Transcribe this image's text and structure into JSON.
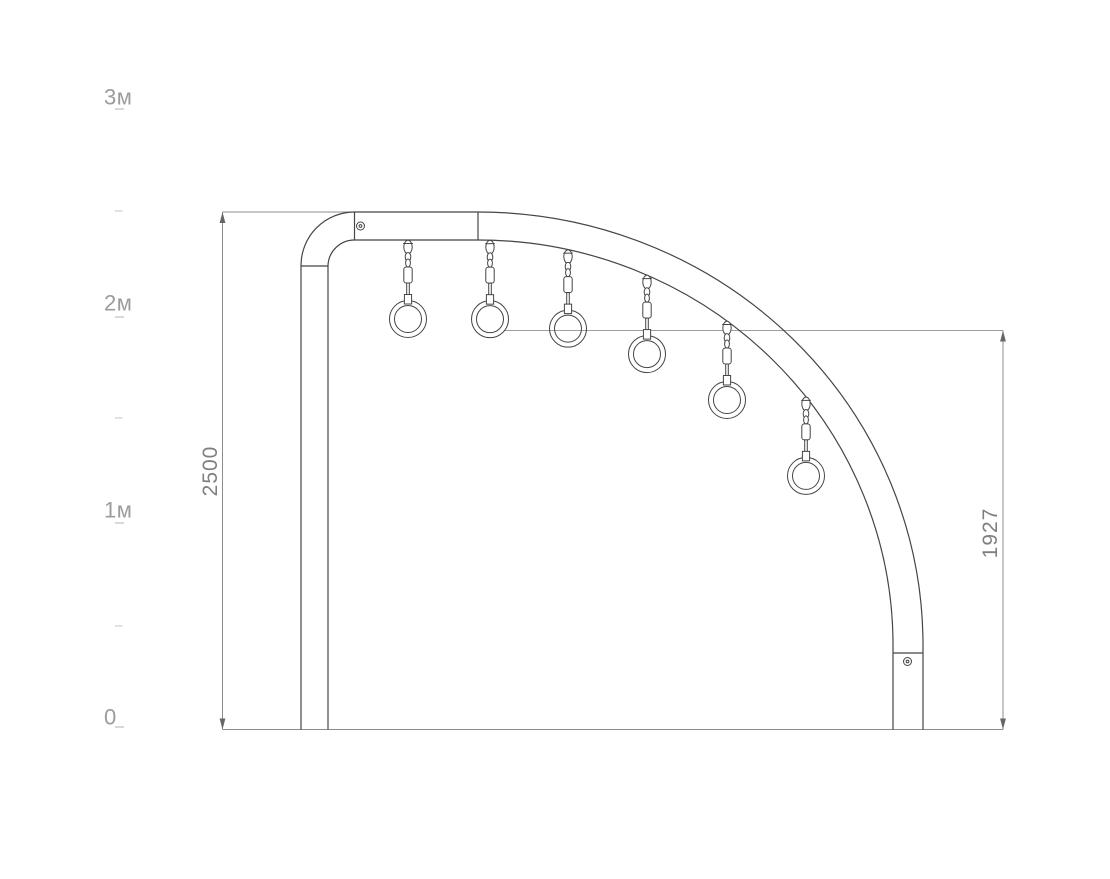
{
  "page": {
    "width": 1110,
    "height": 879,
    "background": "#ffffff"
  },
  "scale_ruler": {
    "label_x": 104,
    "tick_x": 115,
    "major_tick_w": 9,
    "minor_tick_w": 7.5,
    "label_color": "#9b9b9b",
    "major_tick_color": "#cccccc",
    "minor_tick_color": "#d8d8d8",
    "labels": [
      {
        "text": "3м",
        "y": 98
      },
      {
        "text": "2м",
        "y": 304
      },
      {
        "text": "1м",
        "y": 511
      },
      {
        "text": "0",
        "y": 718
      }
    ],
    "major_ticks_y": [
      109,
      317,
      523,
      727
    ],
    "minor_ticks_y": [
      211,
      418,
      626
    ]
  },
  "dimensions": {
    "color": "#8c8c8c",
    "arrow_color": "#666666",
    "reference_color": "#9e9e9e",
    "text_color": "#7f7f7f",
    "left": {
      "value": "2500",
      "line_x": 222.5,
      "top_y": 212,
      "bottom_y": 729.5,
      "ext_x2": 354.5,
      "label_x": 211,
      "label_y": 471
    },
    "right": {
      "value": "1927",
      "line_x": 1003,
      "top_y": 330.5,
      "bottom_y": 729.5,
      "label_x": 991,
      "label_y": 533
    },
    "ground_line": {
      "x1": 222.5,
      "x2": 1003,
      "y": 729.5
    },
    "reference_line": {
      "x1": 504,
      "x2": 1003,
      "y": 330.5
    }
  },
  "structure": {
    "stroke": "#454545",
    "left_post": {
      "x1": 301,
      "x2": 328,
      "top_y": 266,
      "bottom_y": 729.5
    },
    "elbow": {
      "corner_x": 354.5,
      "outer_r": 53.5,
      "inner_r": 26.5
    },
    "beam": {
      "top_y": 212,
      "bottom_y": 240,
      "x_start": 354.5,
      "x_end": 478
    },
    "arc": {
      "end_y": 645,
      "inner_rx": 415,
      "inner_ry": 405,
      "outer_rx": 445,
      "outer_ry": 433
    },
    "right_post": {
      "x1": 893,
      "x2": 923,
      "joint_y": 653,
      "bottom_y": 729.5
    },
    "screws": [
      {
        "cx": 360.5,
        "cy": 226
      },
      {
        "cx": 907.5,
        "cy": 661.5
      }
    ]
  },
  "rings": {
    "count": 6,
    "x_positions": [
      408,
      490,
      568,
      647,
      727,
      806
    ],
    "outer_r": 18.5,
    "inner_r": 13.5,
    "chain_drop": 79
  }
}
